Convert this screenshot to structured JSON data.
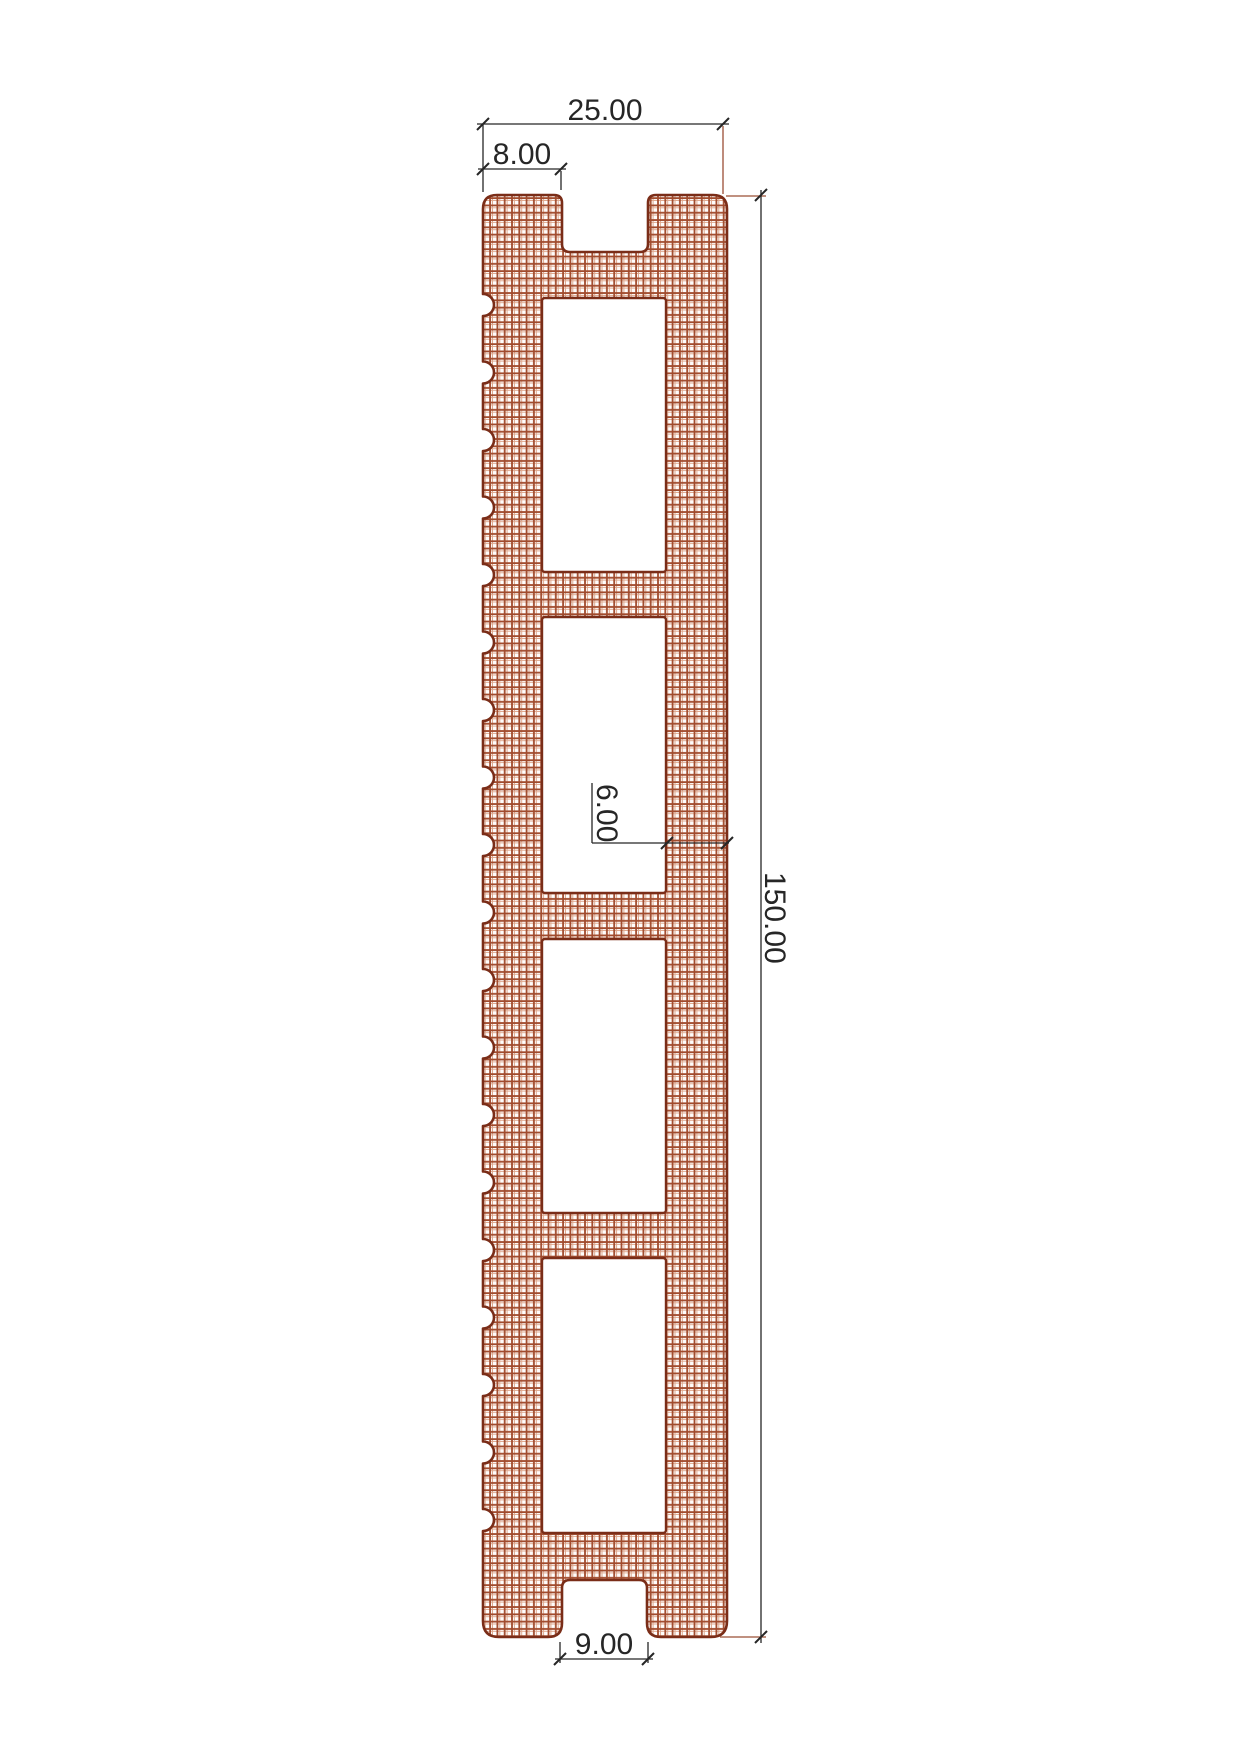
{
  "drawing": {
    "type": "cad-cross-section-profile",
    "dimensions": {
      "overall_width": "25.00",
      "top_groove_offset": "8.00",
      "overall_length": "150.00",
      "face_wall_thickness": "6.00",
      "bottom_groove_width": "9.00"
    },
    "colors": {
      "outline": "#7a2d18",
      "hatch_dark": "#a14b2d",
      "hatch_light": "#dfa98f",
      "dimension": "#262626",
      "extension": "#9b4f35",
      "background": "#ffffff"
    }
  }
}
